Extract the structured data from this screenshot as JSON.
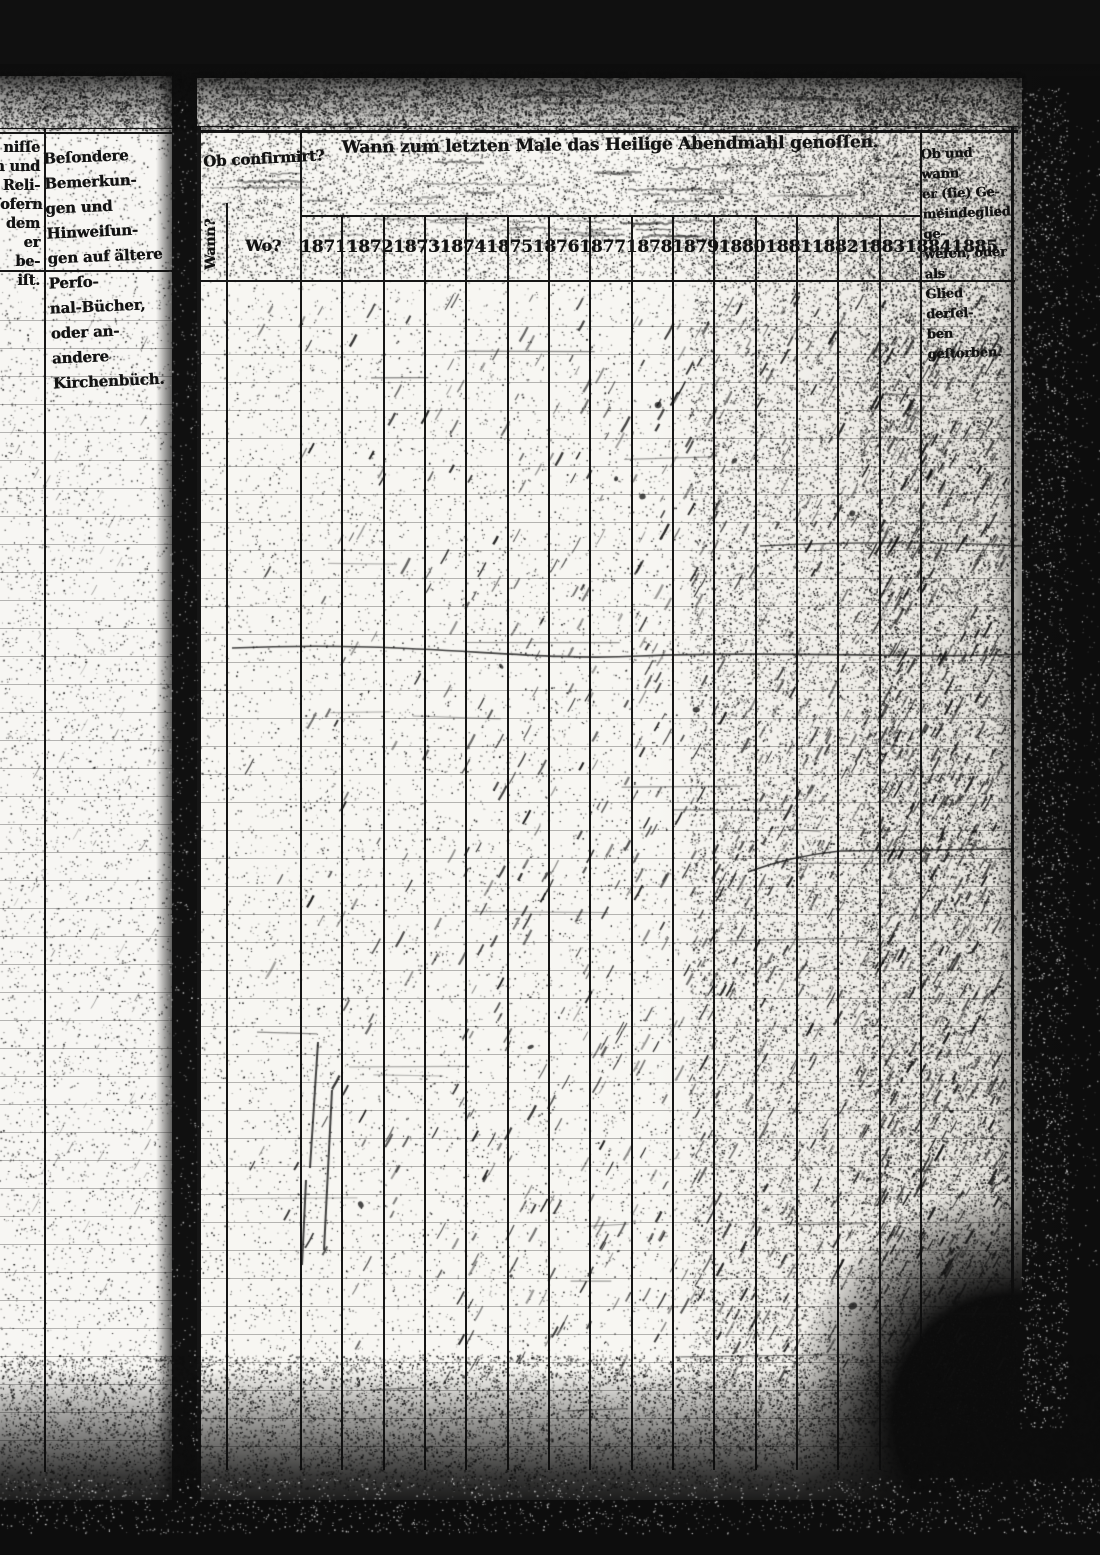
{
  "left_page": {
    "clipped_lines": [
      "niſſe",
      "n und",
      "Reli-",
      "ſofern",
      "dem",
      "er be-",
      "iſt."
    ],
    "remarks_lines": [
      "Beſondere Bemerkun-",
      "gen und Hinweiſun-",
      "gen auf ältere Perſo-",
      "nal-Bücher, oder an-",
      "andere Kirchenbüch."
    ]
  },
  "main_page": {
    "confirm_label": "Ob confirmirt?",
    "wann_label": "Wann?",
    "wo_label": "Wo?",
    "title": "Wann zum letzten Male das Heilige Abendmahl genoſſen.",
    "years": [
      "1871",
      "1872",
      "1873",
      "1874",
      "1875",
      "1876",
      "1877",
      "1878",
      "1879",
      "1880",
      "1881",
      "1882",
      "1883",
      "1884",
      "1885"
    ],
    "right_header_lines": [
      "Ob und wann",
      "er (ſie) Ge-",
      "meindeglied ge-",
      "weſen, oder als",
      "Glied derſel-",
      "ben geſtorben."
    ]
  }
}
